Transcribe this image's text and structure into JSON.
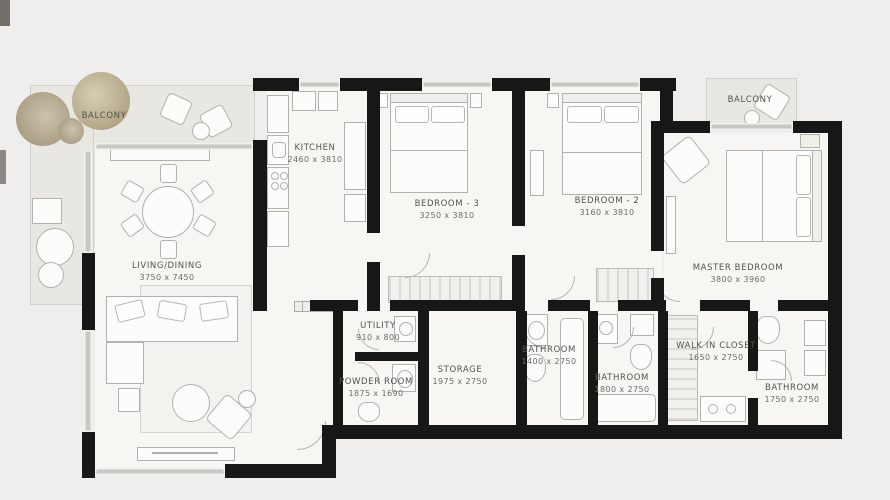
{
  "plan_title": "Apartment Floor Plan",
  "rooms": {
    "balcony_left": {
      "name": "BALCONY",
      "dims": ""
    },
    "balcony_right": {
      "name": "BALCONY",
      "dims": ""
    },
    "kitchen": {
      "name": "KITCHEN",
      "dims": "2460 x 3810"
    },
    "bedroom3": {
      "name": "BEDROOM - 3",
      "dims": "3250 x 3810"
    },
    "bedroom2": {
      "name": "BEDROOM - 2",
      "dims": "3160 x 3810"
    },
    "master_bedroom": {
      "name": "MASTER BEDROOM",
      "dims": "3800 x 3960"
    },
    "living_dining": {
      "name": "LIVING/DINING",
      "dims": "3750 x 7450"
    },
    "utility": {
      "name": "UTILITY",
      "dims": "910 x 800"
    },
    "powder_room": {
      "name": "POWDER ROOM",
      "dims": "1875 x 1690"
    },
    "storage": {
      "name": "STORAGE",
      "dims": "1975 x 2750"
    },
    "bathroom_center": {
      "name": "BATHROOM",
      "dims": "1400 x 2750"
    },
    "bathroom_middle": {
      "name": "BATHROOM",
      "dims": "1800 x 2750"
    },
    "walk_in_closet": {
      "name": "WALK IN CLOSET",
      "dims": "1650 x 2750"
    },
    "bathroom_right": {
      "name": "BATHROOM",
      "dims": "1750 x 2750"
    }
  },
  "palette": {
    "background": "#efeeec",
    "wall": "#171717",
    "room_fill": "#f7f6f3",
    "balcony_fill": "#e9e7e2",
    "label_text": "#54524e",
    "furniture_line": "#b3b1ac",
    "plant_tan": "#b2a787"
  }
}
